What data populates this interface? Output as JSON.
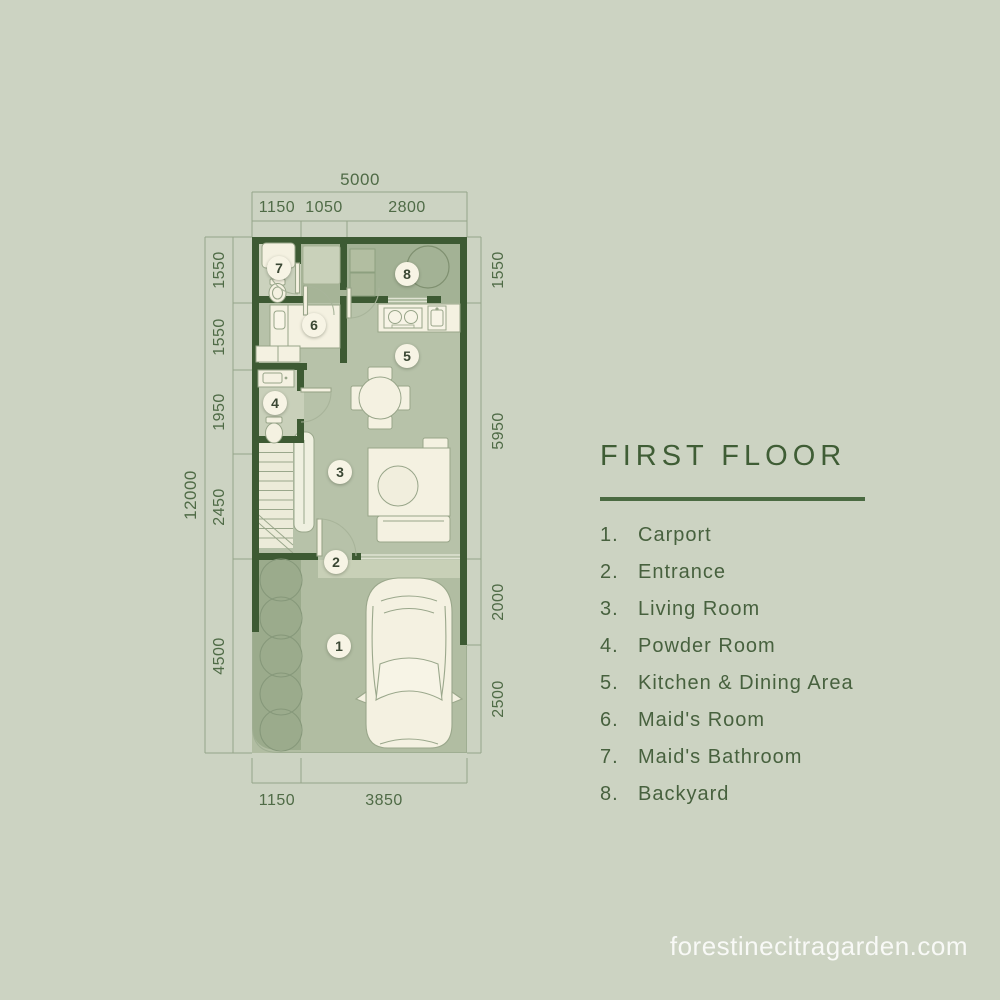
{
  "plan": {
    "rooms": [
      {
        "number": "1",
        "name": "Carport"
      },
      {
        "number": "2",
        "name": "Entrance"
      },
      {
        "number": "3",
        "name": "Living Room"
      },
      {
        "number": "4",
        "name": "Powder Room"
      },
      {
        "number": "5",
        "name": "Kitchen & Dining Area"
      },
      {
        "number": "6",
        "name": "Maid's Room"
      },
      {
        "number": "7",
        "name": "Maid's Bathroom"
      },
      {
        "number": "8",
        "name": "Backyard"
      }
    ],
    "dimensions": {
      "top": {
        "total": "5000",
        "segments": [
          "1150",
          "1050",
          "2800"
        ]
      },
      "left": {
        "total": "12000",
        "segments": [
          "1550",
          "1550",
          "1950",
          "2450",
          "4500"
        ]
      },
      "right": {
        "segments": [
          "1550",
          "5950",
          "2000",
          "2500"
        ]
      },
      "bottom": {
        "segments": [
          "1150",
          "3850"
        ]
      }
    }
  },
  "panel": {
    "title": "FIRST FLOOR",
    "legend": [
      {
        "num": "1.",
        "label": "Carport"
      },
      {
        "num": "2.",
        "label": "Entrance"
      },
      {
        "num": "3.",
        "label": "Living Room"
      },
      {
        "num": "4.",
        "label": "Powder Room"
      },
      {
        "num": "5.",
        "label": "Kitchen & Dining Area"
      },
      {
        "num": "6.",
        "label": "Maid's Room"
      },
      {
        "num": "7.",
        "label": "Maid's Bathroom"
      },
      {
        "num": "8.",
        "label": "Backyard"
      }
    ]
  },
  "watermark": "forestinecitragarden.com",
  "colors": {
    "background": "#ccd3c2",
    "wall": "#3d5a33",
    "accent_green": "#3f5d35",
    "floor_main": "#b7c2a9",
    "floor_dark": "#a3b295",
    "floor_pale": "#cbd2bd",
    "carport_floor": "#b1bda2",
    "garden_strip": "#9bab8c",
    "furniture_cream": "#f4f1e1",
    "dimension_line": "#95a489"
  }
}
